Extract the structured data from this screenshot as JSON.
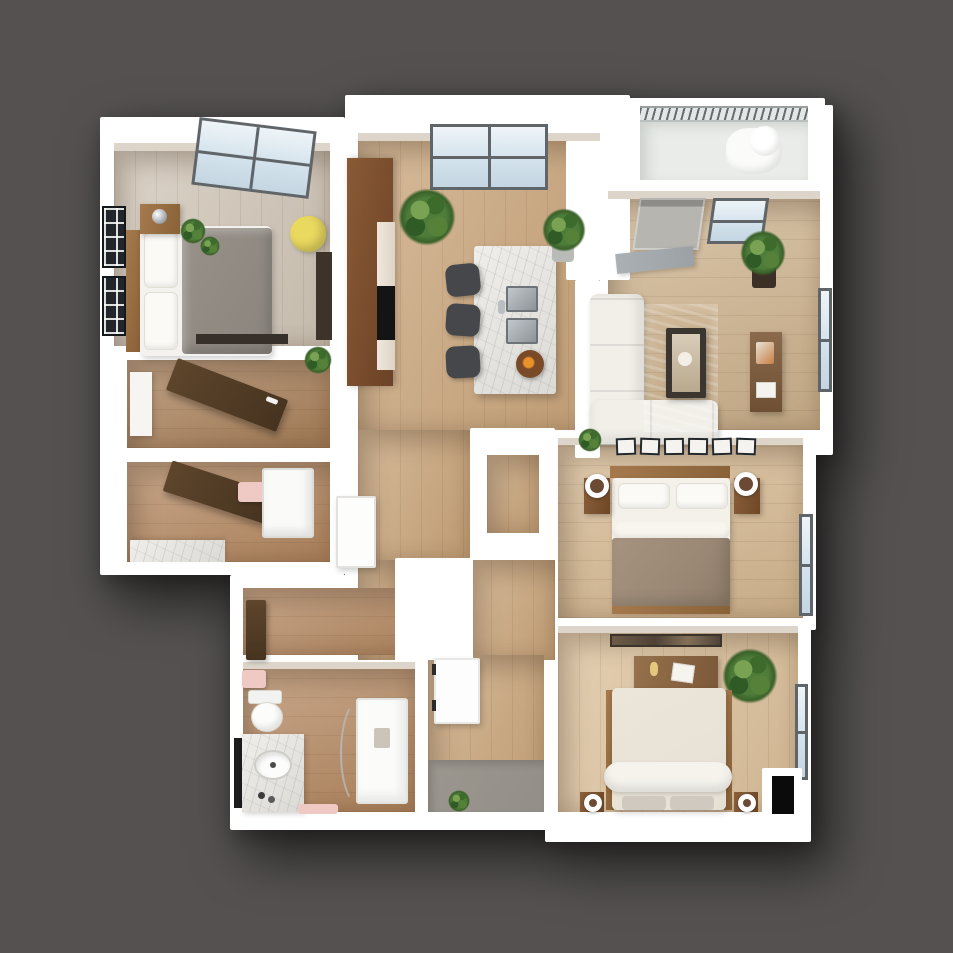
{
  "meta": {
    "kind": "3d-floor-plan-render",
    "view": "top-down isometric",
    "visible_text": "none"
  },
  "palette": {
    "bg": "#545150",
    "wall": "#ffffff",
    "wall-face": "#ddd5c9",
    "window-frame": "#5f6569",
    "floor-bedroom1": "#d0c5b6",
    "floor-hall": "#c9a479",
    "floor-living": "#cdb18b",
    "floor-master": "#d5b78f",
    "floor-bed3": "#dcc09a",
    "floor-bath": "#b4875f",
    "floor-closet": "#a87f58",
    "floor-balcony": "#e9ece8",
    "rug-teal": "#6f9b97",
    "duvet-gray": "#98918a",
    "duvet-taupe": "#9a8875",
    "bed-cream": "#e7e1d5",
    "cabinet-brown": "#7c4f2e",
    "wood-furn": "#a5794d",
    "door-brown": "#57432f",
    "door-gray": "#b7b5b0",
    "chair-yellow": "#e9d95f",
    "stool-dark": "#45474a",
    "steel": "#9aa1a6",
    "black": "#0b0b0b",
    "pink": "#efcac4",
    "mat-gray": "#938f88",
    "media-gray": "#9ba1a5"
  },
  "rooms": [
    {
      "name": "bedroom-1",
      "position": "top-left",
      "furniture": [
        "double-bed-gray-duvet",
        "wood-headboard",
        "nightstand-with-chrome-lamp",
        "two-plants",
        "yellow-desk-chair",
        "narrow-desk",
        "media-strip",
        "skylight-window",
        "two-dark-framed-windows"
      ]
    },
    {
      "name": "kitchen",
      "position": "top-center",
      "furniture": [
        "tall-brown-cabinets",
        "counter-with-black-cooktop",
        "marble-island",
        "double-steel-sink",
        "fruit-bowl",
        "three-bar-stools",
        "large-window",
        "two-plants"
      ]
    },
    {
      "name": "living-room",
      "position": "top-right",
      "furniture": [
        "l-shaped-white-sofa",
        "teal-rug",
        "dark-coffee-table-with-art",
        "wood-console-table",
        "gray-media-sideboard",
        "balcony-door",
        "two-windows",
        "corner-plant"
      ]
    },
    {
      "name": "balcony",
      "position": "top-right-edge",
      "furniture": [
        "railing",
        "lounge-chair"
      ]
    },
    {
      "name": "walk-in-closet",
      "position": "mid-left",
      "furniture": [
        "brown-door-ajar",
        "white-shelf"
      ]
    },
    {
      "name": "bathroom-2",
      "position": "mid-left-lower",
      "furniture": [
        "brown-door-ajar",
        "pink-towel",
        "shower-stall",
        "marble-counter"
      ]
    },
    {
      "name": "master-bedroom",
      "position": "right-middle",
      "furniture": [
        "double-bed-taupe-duvet",
        "two-pillows",
        "two-nightstands",
        "two-round-mirror-lamps",
        "gallery-of-six-frames",
        "window",
        "walk-in-niche"
      ]
    },
    {
      "name": "bedroom-3",
      "position": "bottom-right",
      "furniture": [
        "double-bed-cream-duvet",
        "duvet-roll",
        "two-gray-pillows",
        "two-nightstands-with-ring-lamps",
        "dresser",
        "wall-mirror",
        "plant",
        "window",
        "wall-tv"
      ]
    },
    {
      "name": "bathroom-1",
      "position": "bottom-left",
      "furniture": [
        "toilet",
        "pink-towel",
        "marble-vanity-with-oval-sink",
        "black-mirror",
        "curved-glass-shower",
        "pink-mat"
      ]
    },
    {
      "name": "entry",
      "position": "bottom-center",
      "furniture": [
        "white-entry-door",
        "gray-floor-mat",
        "small-plant"
      ]
    },
    {
      "name": "hallway",
      "position": "center",
      "furniture": [
        "white-interior-door",
        "brown-interior-door",
        "plant"
      ]
    }
  ]
}
